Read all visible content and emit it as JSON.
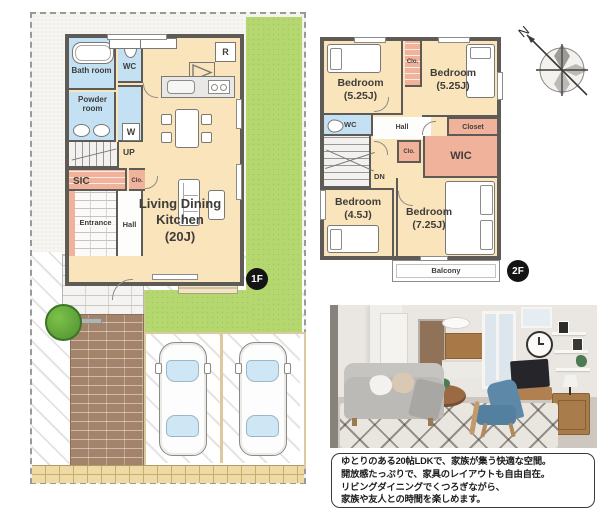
{
  "plan_1f": {
    "badge": "1F",
    "labels": {
      "bath": "Bath room",
      "wc": "WC",
      "powder": "Powder room",
      "washer": "W",
      "up": "UP",
      "sic": "SIC",
      "clo": "Clo.",
      "entrance": "Entrance",
      "hall": "Hall",
      "ldk_name": "Living Dining Kitchen",
      "ldk_size": "(20J)",
      "fridge": "R"
    }
  },
  "plan_2f": {
    "badge": "2F",
    "compass_n": "N",
    "labels": {
      "bedroom_tl_name": "Bedroom",
      "bedroom_tl_size": "(5.25J)",
      "bedroom_tr_name": "Bedroom",
      "bedroom_tr_size": "(5.25J)",
      "bedroom_bl_name": "Bedroom",
      "bedroom_bl_size": "(4.5J)",
      "bedroom_br_name": "Bedroom",
      "bedroom_br_size": "(7.25J)",
      "wc": "WC",
      "hall": "Hall",
      "closet": "Closet",
      "clo_top": "Clo.",
      "clo_mid": "Clo.",
      "wic": "WIC",
      "dn": "DN",
      "balcony": "Balcony"
    }
  },
  "caption": {
    "lines": [
      "ゆとりのある20帖LDKで、家族が集う快適な空間。",
      "開放感たっぷりで、家具のレイアウトも自由自在。",
      "リビングダイニングでくつろぎながら、",
      "家族や友人との時間を楽しめます。"
    ]
  },
  "colors": {
    "room_beige": "#f9e4bb",
    "wet_area_blue": "#c3e1f3",
    "closet_salmon": "#f0b29a",
    "garden_green": "#b4d86f",
    "wall_gray": "#5e5b57",
    "path_brown": "#a3846a",
    "curb_tan": "#eedaa4",
    "badge_black": "#141414"
  }
}
